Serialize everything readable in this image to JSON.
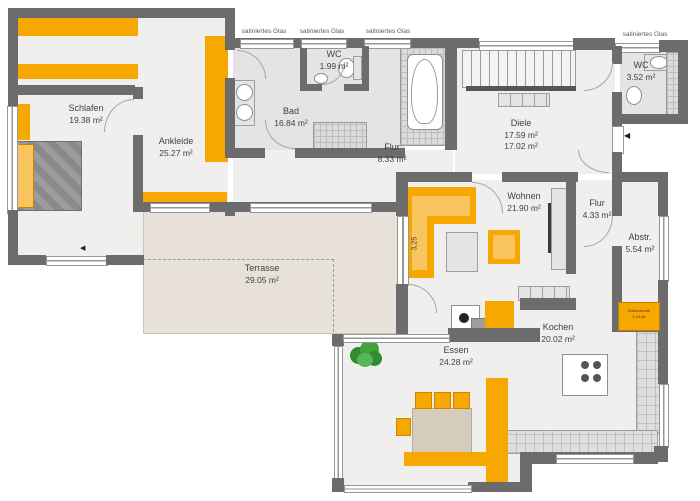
{
  "plan": {
    "glass_labels": [
      "satiniertes Glas",
      "satiniertes Glas",
      "satiniertes Glas",
      "satiniertes Glas"
    ],
    "rooms": {
      "schlafen": {
        "name": "Schlafen",
        "area": "19.38 m²"
      },
      "ankleide": {
        "name": "Ankleide",
        "area": "25.27 m²"
      },
      "bad": {
        "name": "Bad",
        "area": "16.84 m²"
      },
      "wc1": {
        "name": "WC",
        "area": "1.99 m²"
      },
      "flur1": {
        "name": "Flur",
        "area": "8.33 m²"
      },
      "diele": {
        "name": "Diele",
        "area": "17.59 m²",
        "area2": "17.02 m²"
      },
      "wc2": {
        "name": "WC",
        "area": "3.52 m²"
      },
      "wohnen": {
        "name": "Wohnen",
        "area": "21.90 m²"
      },
      "flur2": {
        "name": "Flur",
        "area": "4.33 m²"
      },
      "abstr": {
        "name": "Abstr.",
        "area": "5.54 m²"
      },
      "terrasse": {
        "name": "Terrasse",
        "area": "29.05 m²"
      },
      "essen": {
        "name": "Essen",
        "area": "24.28 m²"
      },
      "kochen": {
        "name": "Kochen",
        "area": "20.02 m²"
      }
    },
    "annotations": {
      "sofa_dimension": "3,25",
      "storage_unit_line1": "Kühlschrank",
      "storage_unit_line2": "1.20.60",
      "entrance_arrow": "◀",
      "bedroom_arrow": "◀"
    },
    "colors": {
      "accent_orange": "#F6A800",
      "accent_orange_light": "#F8C55F",
      "wall_gray": "#6C6C6C",
      "floor_light": "#F0EFED",
      "floor_bath": "#E4E4E4",
      "terrace_beige": "#E7E1D9",
      "plant_green": "#2F8C2F"
    }
  }
}
